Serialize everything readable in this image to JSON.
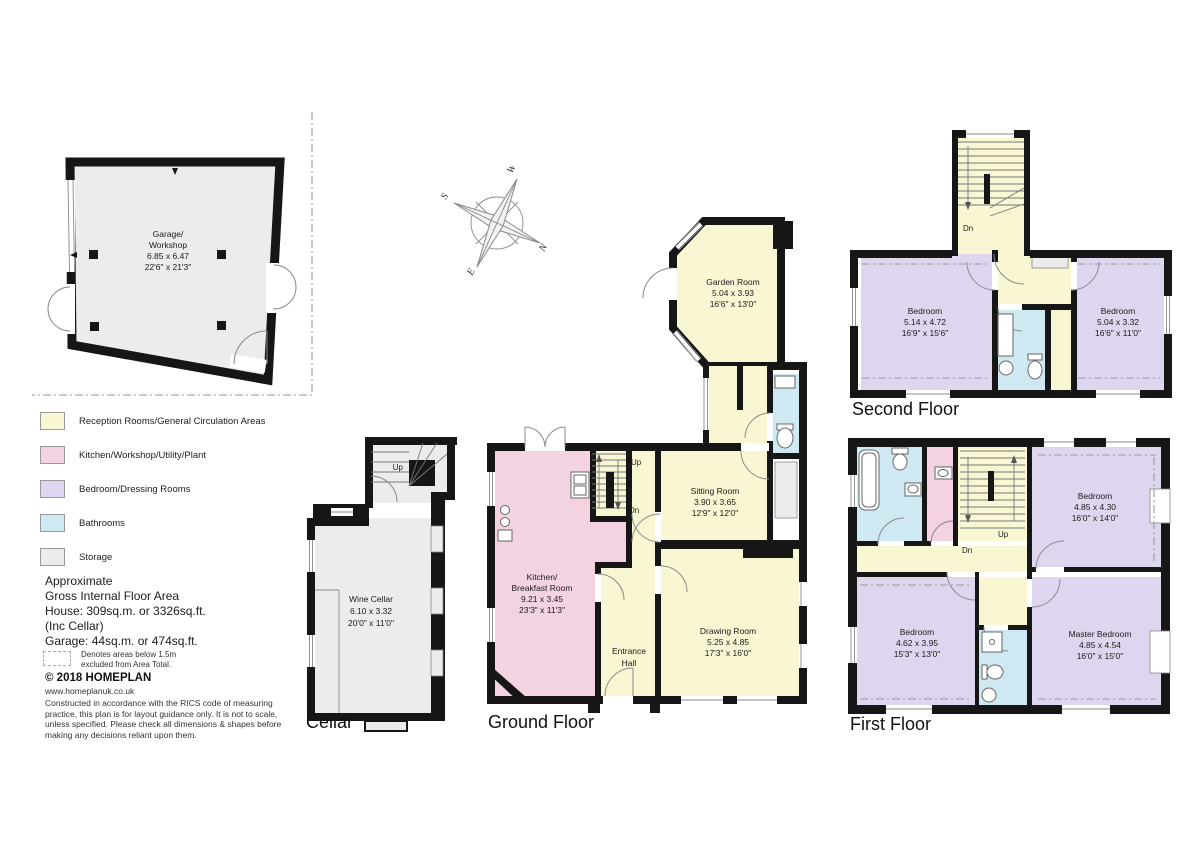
{
  "legend": {
    "items": [
      {
        "label": "Reception Rooms/General Circulation Areas",
        "color": "#f9f6d3"
      },
      {
        "label": "Kitchen/Workshop/Utility/Plant",
        "color": "#f3d2e2"
      },
      {
        "label": "Bedroom/Dressing Rooms",
        "color": "#ded6ee"
      },
      {
        "label": "Bathrooms",
        "color": "#cfe9f3"
      },
      {
        "label": "Storage",
        "color": "#ececea"
      }
    ]
  },
  "area_summary": {
    "lines": [
      "Approximate",
      "Gross Internal Floor Area",
      "House: 309sq.m. or 3326sq.ft.",
      "(Inc Cellar)",
      "Garage: 44sq.m. or 474sq.ft."
    ]
  },
  "exclusion_note": {
    "line1": "Denotes areas below 1.5m",
    "line2": "excluded from Area Total."
  },
  "copyright": {
    "brand": "© 2018 HOMEPLAN",
    "website": "www.homeplanuk.co.uk",
    "disclaimer_lines": [
      "Constructed in accordance with the RICS code of measuring",
      "practice, this plan is for layout guidance only. It is not to scale,",
      "unless specified.  Please check all dimensions & shapes before",
      "making any decisions reliant upon them."
    ]
  },
  "compass": {
    "north": "N",
    "south": "S",
    "east": "E",
    "west": "W"
  },
  "plans": {
    "garage": {
      "room_line1": "Garage/",
      "room_line2": "Workshop",
      "metric": "6.85 x 6.47",
      "imperial": "22'6\" x 21'3\""
    },
    "cellar": {
      "label": "Cellar",
      "up": "Up",
      "room": "Wine Cellar",
      "metric": "6.10 x 3.32",
      "imperial": "20'0\" x 11'0\""
    },
    "ground": {
      "label": "Ground Floor",
      "up": "Up",
      "dn": "Dn",
      "garden": {
        "name": "Garden Room",
        "metric": "5.04 x 3.93",
        "imperial": "16'6\" x 13'0\""
      },
      "sitting": {
        "name": "Sitting Room",
        "metric": "3.90 x 3.65",
        "imperial": "12'9\" x 12'0\""
      },
      "kitchen": {
        "name1": "Kitchen/",
        "name2": "Breakfast Room",
        "metric": "9.21 x 3.45",
        "imperial": "23'3\" x 11'3\""
      },
      "entrance": {
        "name1": "Entrance",
        "name2": "Hall"
      },
      "drawing": {
        "name": "Drawing Room",
        "metric": "5.25 x 4.85",
        "imperial": "17'3\" x 16'0\""
      }
    },
    "first": {
      "label": "First Floor",
      "up": "Up",
      "dn": "Dn",
      "bedroom_ne": {
        "name": "Bedroom",
        "metric": "4.85 x 4.30",
        "imperial": "16'0\" x 14'0\""
      },
      "bedroom_sw": {
        "name": "Bedroom",
        "metric": "4.62 x 3.95",
        "imperial": "15'3\" x 13'0\""
      },
      "master": {
        "name": "Master Bedroom",
        "metric": "4.85 x 4.54",
        "imperial": "16'0\" x 15'0\""
      }
    },
    "second": {
      "label": "Second Floor",
      "dn": "Dn",
      "bedroom_w": {
        "name": "Bedroom",
        "metric": "5.14 x 4.72",
        "imperial": "16'9\" x 15'6\""
      },
      "bedroom_e": {
        "name": "Bedroom",
        "metric": "5.04 x 3.32",
        "imperial": "16'6\" x 11'0\""
      }
    }
  }
}
